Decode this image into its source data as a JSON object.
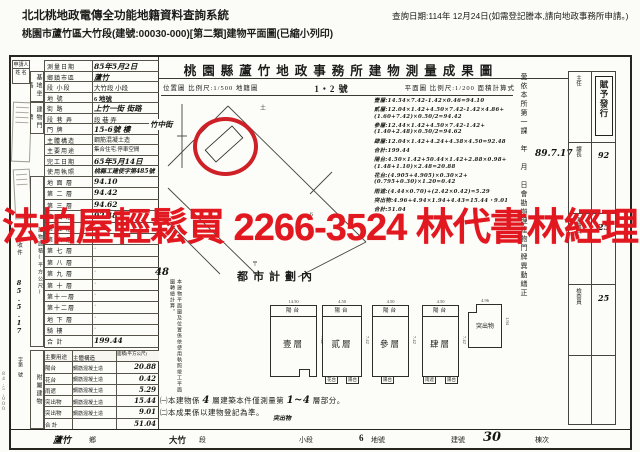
{
  "header": {
    "system_title": "北北桃地政電傳全功能地籍資料查詢系統",
    "print_subtitle": "桃園市蘆竹區大竹段(建號:00030-000)[第二類]建物平面圖(已縮小列印)",
    "query_date": "查詢日期:114年 12月24日(如需登記謄本,請向地政事務所申請。)"
  },
  "watermark": {
    "text": "法拍屋輕鬆買 2266-3524 林代書林經理",
    "color": "#e21820"
  },
  "doc": {
    "title": "桃園縣蘆竹地政事務所建物測量成果圖",
    "scale_row": {
      "left": "位置圖 比例尺:1/500 地籍圖",
      "center": "1・2 號",
      "right": "平面圖 比例尺:1/200 面積計算式"
    },
    "applicant": {
      "label1": "申請人",
      "label2": "姓 名"
    },
    "receipt": {
      "label": "收件",
      "date_hw": "85.5.17",
      "no_label": "字第 號"
    },
    "groups": {
      "site": "基地坐落",
      "door": "建物門牌",
      "area": "建物面積(平方公尺)",
      "annex": "附屬建物"
    },
    "info_rows": [
      {
        "label": "測量日期",
        "value": "85年5月2日"
      },
      {
        "label": "鄉鎮市區",
        "value": "蘆竹"
      },
      {
        "label": "段 小段",
        "value": "大竹段 小段"
      },
      {
        "label": "地 號",
        "value": "6 地號"
      },
      {
        "label": "街 路",
        "value": "上竹一街 街路"
      },
      {
        "label": "段 巷 弄",
        "value": "段 巷 弄"
      },
      {
        "label": "門 牌",
        "value": "15-6號 樓"
      },
      {
        "label": "主體構造",
        "value": "鋼筋混凝土造"
      },
      {
        "label": "主要用途",
        "value": "集合住宅.停車空間"
      },
      {
        "label": "完工日期",
        "value": "65年5月14日"
      },
      {
        "label": "使用執照",
        "value": "桃縣工建使字第485號"
      }
    ],
    "floors": [
      {
        "label": "地 面 層",
        "value": "94.10"
      },
      {
        "label": "第 二 層",
        "value": "94.42"
      },
      {
        "label": "第 三 層",
        "value": "94.62"
      },
      {
        "label": "第 四 層",
        "value": "92.48"
      },
      {
        "label": "第 五 層",
        "value": "·"
      },
      {
        "label": "第 六 層",
        "value": "·"
      },
      {
        "label": "第 七 層",
        "value": "·"
      },
      {
        "label": "第 八 層",
        "value": "·"
      },
      {
        "label": "第 九 層",
        "value": "·"
      },
      {
        "label": "第 十 層",
        "value": "·"
      },
      {
        "label": "第十一層",
        "value": "·"
      },
      {
        "label": "第十二層",
        "value": "·"
      },
      {
        "label": "地 下 層",
        "value": "·"
      },
      {
        "label": "騎 樓",
        "value": "·"
      },
      {
        "label": "合 計",
        "value": "199.44"
      }
    ],
    "annex": {
      "headers": [
        "主要用途",
        "主體構造",
        "面積(平方公尺)"
      ],
      "rows": [
        [
          "陽台",
          "鋼筋混凝土造",
          "20.88"
        ],
        [
          "花台",
          "鋼筋混凝土造",
          "0.42"
        ],
        [
          "雨遮",
          "鋼筋混凝土造",
          "5.29"
        ],
        [
          "突出物",
          "鋼筋混凝土造",
          "15.44"
        ],
        [
          "突出物",
          "鋼筋混凝土造",
          "9.01"
        ],
        [
          "合 計",
          "",
          "51.04"
        ]
      ]
    },
    "map": {
      "street_hw": "竹中街",
      "zone": "都市計劃內"
    },
    "plan_note": {
      "hw": "48",
      "text": "本建物平面圖及位置係依使用執照竣工平面圖轉繪計算。"
    },
    "formulas": [
      "壹層:14.54×7.42-1.42×0.46=94.10",
      "貳層:12.04×1.42+4.50×7.42-1.42×4.86+(1.60+7.42)×0.50/2=94.42",
      "參層:12.44×1.42+4.50×7.42-1.42+(1.40+2.48)×0.50/2=94.62",
      "肆層:12.04×1.42+4.24+4.38×4.50=92.48",
      "合計:199.44",
      "陽台:4.50×1.42+50.44×1.42+2.88×0.98+(1.48+1.10)×2.48=20.88",
      "花台:(4.905+4.905)×0.30×2+(0.795+0.30)×1.20=0.42",
      "雨遮:(4.44×0.70)+(2.42×0.42)=5.29",
      "突出物:4.96+4.94×1.94+4.43=15.44・9.01",
      "合計:51.04"
    ],
    "right_note": {
      "text": "愛依本所第一課　年　月　日會勘辦理建物門牌異動繕正",
      "date_hw": "89.7.17"
    },
    "sign": {
      "stamp": "賦予發行",
      "cells": [
        "主任",
        "課長",
        "測量員",
        "檢查員"
      ],
      "marks": [
        "92",
        "25",
        "25"
      ]
    },
    "plans": [
      {
        "name": "壹層",
        "balcony": "陽台",
        "dim_top": "14.50",
        "dim_side": "7.42",
        "tabs": []
      },
      {
        "name": "貳層",
        "balcony": "陽台",
        "dim_top": "4.50",
        "dim_side": "7.42",
        "tabs": [
          "花台",
          "陽台"
        ]
      },
      {
        "name": "參層",
        "balcony": "陽台",
        "dim_top": "4.50",
        "dim_side": "7.42",
        "tabs": [
          "陽台"
        ]
      },
      {
        "name": "肆層",
        "balcony": "陽台",
        "dim_top": "4.50",
        "dim_side": "7.42",
        "tabs": [
          "雨遮",
          "陽台"
        ]
      },
      {
        "name": "突出物",
        "balcony": "",
        "dim_top": "4.96",
        "dim_side": "1.94",
        "tabs": []
      }
    ],
    "notes": {
      "n1a": "㈠本建物係",
      "n1b": "4",
      "n1c": "層建築本件僅測量第",
      "n1d": "1~4",
      "n1e": "層部分。",
      "n2": "㈡本成果係以建物登記為準。",
      "hw": "突出物"
    },
    "bottom_bar": {
      "town_hw": "蘆竹",
      "town_suffix": "鄉",
      "section": "大竹",
      "section_suffix": "段",
      "subsection": "小段",
      "lot": "6",
      "lot_suffix": "地號",
      "bldg_label": "建號",
      "bldg_no": "30",
      "unit": "棟次"
    },
    "print_code": "84.5,000"
  }
}
